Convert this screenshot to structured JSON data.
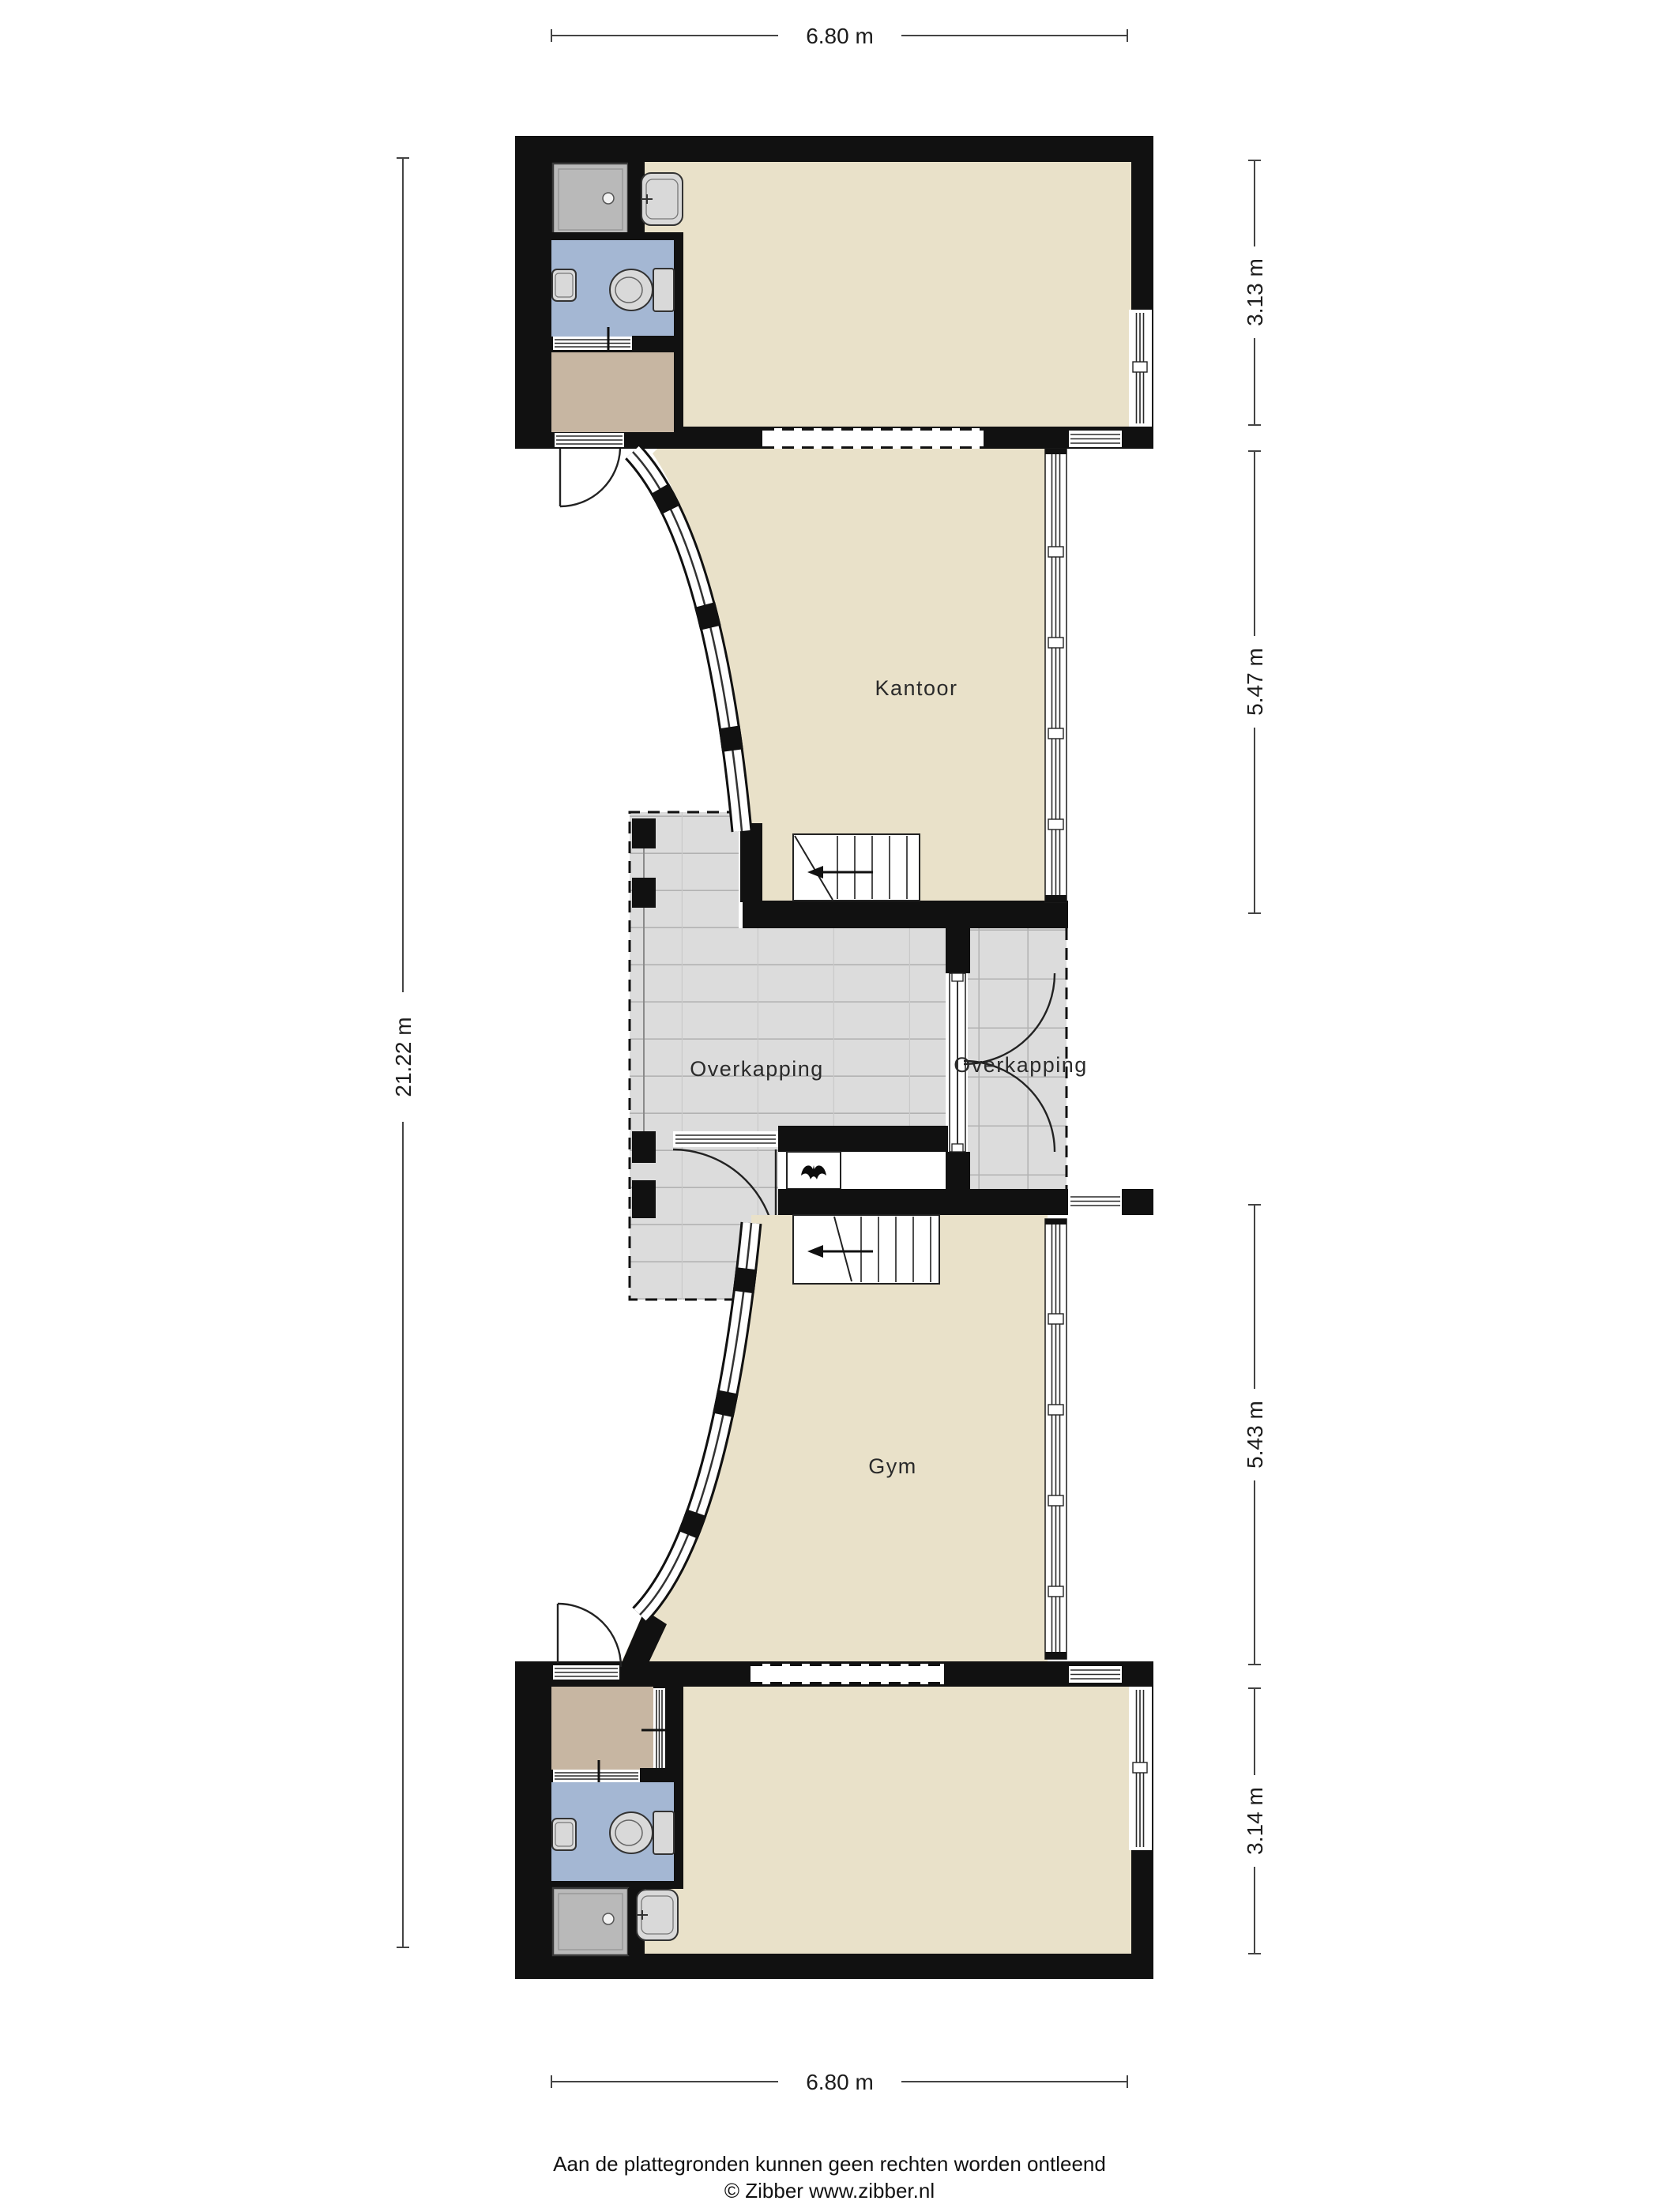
{
  "dimensions": {
    "top": "6.80 m",
    "bottom": "6.80 m",
    "left": "21.22 m",
    "right": [
      "3.13 m",
      "5.47 m",
      "5.43 m",
      "3.14 m"
    ]
  },
  "rooms": {
    "kantoor": "Kantoor",
    "gym": "Gym",
    "overkapping_left": "Overkapping",
    "overkapping_right": "Overkapping"
  },
  "footer": {
    "disclaimer": "Aan de plattegronden kunnen geen rechten worden ontleend",
    "copyright": "© Zibber www.zibber.nl"
  },
  "icons": {
    "ventilation-symbol": "bat-silhouette",
    "stairs-direction-arrow": "left-pointing-arrow",
    "shower-drain": "white-dot",
    "door-swing": "quarter-circle-arc"
  },
  "palette": {
    "wall": "#111111",
    "room-beige": "#e9e1c9",
    "room-tan": "#c7b6a2",
    "room-blue": "#a4b7d3",
    "canopy-gray": "#dcdcdc",
    "grid-line": "#b2b2b2",
    "fixture-gray": "#d9d9d9",
    "shower-gray": "#b9b9b9",
    "dim-line": "#444444",
    "text-dark": "#1c1c1c",
    "page-bg": "#ffffff"
  }
}
